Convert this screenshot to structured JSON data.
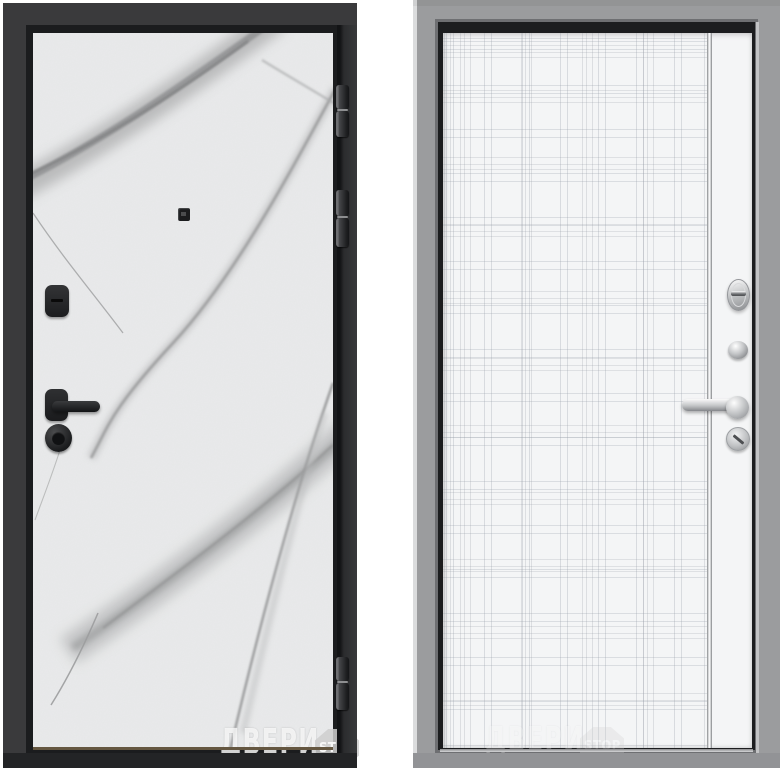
{
  "page": {
    "background": "#ffffff",
    "description": "Product photo of a steel entry door shown from both sides"
  },
  "left_door": {
    "side": "front-marble-black",
    "frame_color": "#3a3a3c",
    "panel_color": "#e9eaeb",
    "vein_color": "#a0a1a2",
    "hardware_color": "#1e1f21",
    "hinge_count": 3,
    "watermark": {
      "text": "ДВЕРИ",
      "badge": "STOP"
    }
  },
  "right_door": {
    "side": "back-white-gray",
    "frame_color": "#9b9c9e",
    "panel_color": "#f4f5f6",
    "line_color": "#99a0aa",
    "hardware_color": "#c4c6c8",
    "watermark": {
      "text": "ДВЕРИ",
      "badge": "STOP"
    }
  }
}
